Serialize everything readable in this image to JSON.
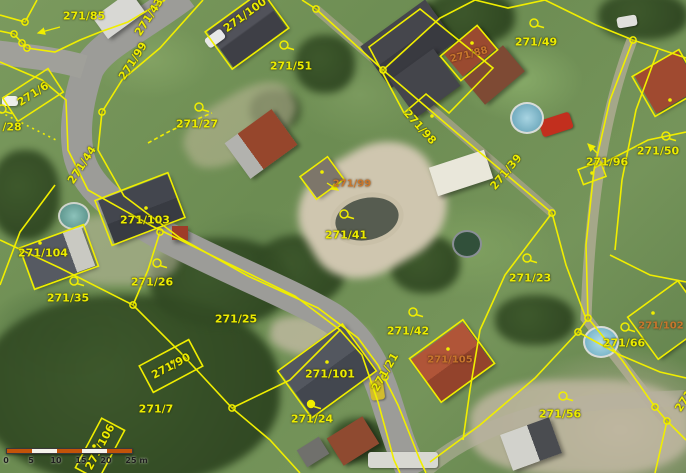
{
  "map": {
    "colors": {
      "boundary": "#f0ee00",
      "label_yellow": "#ecec00",
      "label_orange": "#c8762c",
      "scalebar_orange": "#c35309",
      "scalebar_white": "#f5f2ea",
      "scalebar_text": "#1f1f1f"
    },
    "parcel_labels": [
      {
        "t": "271/85",
        "x": 84,
        "y": 16,
        "r": 0,
        "c": "y"
      },
      {
        "t": "271/43",
        "x": 149,
        "y": 17,
        "r": -57,
        "c": "y"
      },
      {
        "t": "271/99",
        "x": 133,
        "y": 61,
        "r": -57,
        "c": "y"
      },
      {
        "t": "271/100",
        "x": 245,
        "y": 15,
        "r": -36,
        "c": "y"
      },
      {
        "t": "271/51",
        "x": 291,
        "y": 66,
        "r": 0,
        "c": "y"
      },
      {
        "t": "271/49",
        "x": 536,
        "y": 42,
        "r": 0,
        "c": "y"
      },
      {
        "t": "271/88",
        "x": 469,
        "y": 55,
        "r": -14,
        "c": "o"
      },
      {
        "t": "271/98",
        "x": 420,
        "y": 127,
        "r": 48,
        "c": "y"
      },
      {
        "t": "271/99",
        "x": 352,
        "y": 184,
        "r": 0,
        "c": "o"
      },
      {
        "t": "271/41",
        "x": 346,
        "y": 235,
        "r": 0,
        "c": "y"
      },
      {
        "t": "271/39",
        "x": 506,
        "y": 172,
        "r": -50,
        "c": "y"
      },
      {
        "t": "271/96",
        "x": 607,
        "y": 162,
        "r": 0,
        "c": "y"
      },
      {
        "t": "271/50",
        "x": 658,
        "y": 151,
        "r": 0,
        "c": "y"
      },
      {
        "t": "271/27",
        "x": 197,
        "y": 124,
        "r": 0,
        "c": "y"
      },
      {
        "t": "271/44",
        "x": 82,
        "y": 165,
        "r": -57,
        "c": "y"
      },
      {
        "t": "271/6",
        "x": 33,
        "y": 94,
        "r": -33,
        "c": "y"
      },
      {
        "t": "/28",
        "x": 12,
        "y": 127,
        "r": 0,
        "c": "y"
      },
      {
        "t": "271/103",
        "x": 145,
        "y": 220,
        "r": 0,
        "c": "y"
      },
      {
        "t": "271/104",
        "x": 43,
        "y": 253,
        "r": 0,
        "c": "y"
      },
      {
        "t": "271/35",
        "x": 68,
        "y": 298,
        "r": 0,
        "c": "y"
      },
      {
        "t": "271/26",
        "x": 152,
        "y": 282,
        "r": 0,
        "c": "y"
      },
      {
        "t": "271/25",
        "x": 236,
        "y": 319,
        "r": 0,
        "c": "y"
      },
      {
        "t": "271/90",
        "x": 171,
        "y": 366,
        "r": -28,
        "c": "y"
      },
      {
        "t": "271/7",
        "x": 156,
        "y": 409,
        "r": 0,
        "c": "y"
      },
      {
        "t": "271/101",
        "x": 330,
        "y": 374,
        "r": 0,
        "c": "y"
      },
      {
        "t": "271/24",
        "x": 312,
        "y": 419,
        "r": 0,
        "c": "y"
      },
      {
        "t": "271/21",
        "x": 385,
        "y": 372,
        "r": -60,
        "c": "y"
      },
      {
        "t": "271/42",
        "x": 408,
        "y": 331,
        "r": 0,
        "c": "y"
      },
      {
        "t": "271/105",
        "x": 450,
        "y": 360,
        "r": 0,
        "c": "o"
      },
      {
        "t": "271/23",
        "x": 530,
        "y": 278,
        "r": 0,
        "c": "y"
      },
      {
        "t": "271/66",
        "x": 624,
        "y": 343,
        "r": 0,
        "c": "y"
      },
      {
        "t": "271/102",
        "x": 661,
        "y": 326,
        "r": 0,
        "c": "o"
      },
      {
        "t": "271/56",
        "x": 560,
        "y": 414,
        "r": 0,
        "c": "y"
      },
      {
        "t": "271/106",
        "x": 100,
        "y": 447,
        "r": -62,
        "c": "y"
      },
      {
        "t": "271",
        "x": 684,
        "y": 401,
        "r": -57,
        "c": "y"
      }
    ],
    "symbols": [
      {
        "k": "q",
        "x": 284,
        "y": 45
      },
      {
        "k": "q",
        "x": 534,
        "y": 23
      },
      {
        "k": "q",
        "x": 344,
        "y": 214
      },
      {
        "k": "q",
        "x": 199,
        "y": 107
      },
      {
        "k": "q",
        "x": 2,
        "y": 109
      },
      {
        "k": "q",
        "x": 74,
        "y": 281
      },
      {
        "k": "q",
        "x": 157,
        "y": 263
      },
      {
        "k": "q",
        "x": 413,
        "y": 312
      },
      {
        "k": "q",
        "x": 527,
        "y": 258
      },
      {
        "k": "q",
        "x": 625,
        "y": 327
      },
      {
        "k": "q",
        "x": 563,
        "y": 396
      },
      {
        "k": "q",
        "x": 666,
        "y": 136
      },
      {
        "k": "fill",
        "x": 311,
        "y": 404
      },
      {
        "k": "node",
        "x": 25,
        "y": 22
      },
      {
        "k": "node",
        "x": 14,
        "y": 34
      },
      {
        "k": "node",
        "x": 22,
        "y": 43
      },
      {
        "k": "node",
        "x": 27,
        "y": 48
      },
      {
        "k": "node",
        "x": 102,
        "y": 112
      },
      {
        "k": "node",
        "x": 160,
        "y": 232
      },
      {
        "k": "node",
        "x": 316,
        "y": 9
      },
      {
        "k": "node",
        "x": 383,
        "y": 70
      },
      {
        "k": "node",
        "x": 552,
        "y": 213
      },
      {
        "k": "node",
        "x": 588,
        "y": 318
      },
      {
        "k": "node",
        "x": 578,
        "y": 332
      },
      {
        "k": "node",
        "x": 655,
        "y": 407
      },
      {
        "k": "node",
        "x": 667,
        "y": 421
      },
      {
        "k": "node",
        "x": 133,
        "y": 305
      },
      {
        "k": "node",
        "x": 232,
        "y": 408
      },
      {
        "k": "node",
        "x": 385,
        "y": 377
      },
      {
        "k": "node",
        "x": 633,
        "y": 40
      },
      {
        "k": "dot",
        "x": 432,
        "y": 116
      },
      {
        "k": "dot",
        "x": 322,
        "y": 172
      },
      {
        "k": "dot",
        "x": 40,
        "y": 243
      },
      {
        "k": "dot",
        "x": 146,
        "y": 208
      },
      {
        "k": "dot",
        "x": 327,
        "y": 362
      },
      {
        "k": "dot",
        "x": 448,
        "y": 349
      },
      {
        "k": "dot",
        "x": 653,
        "y": 313
      },
      {
        "k": "dot",
        "x": 472,
        "y": 43
      },
      {
        "k": "dot",
        "x": 670,
        "y": 100
      },
      {
        "k": "dot",
        "x": 172,
        "y": 362
      },
      {
        "k": "dot",
        "x": 94,
        "y": 446
      },
      {
        "k": "dot",
        "x": 592,
        "y": 173
      }
    ],
    "arrows": [
      {
        "x1": 60,
        "y1": 27,
        "x2": 38,
        "y2": 33
      },
      {
        "x1": 327,
        "y1": 183,
        "x2": 338,
        "y2": 190
      },
      {
        "x1": 597,
        "y1": 153,
        "x2": 588,
        "y2": 144
      }
    ],
    "scalebar": {
      "ticks": [
        "0",
        "5",
        "10",
        "15",
        "20",
        "25 m"
      ]
    }
  }
}
